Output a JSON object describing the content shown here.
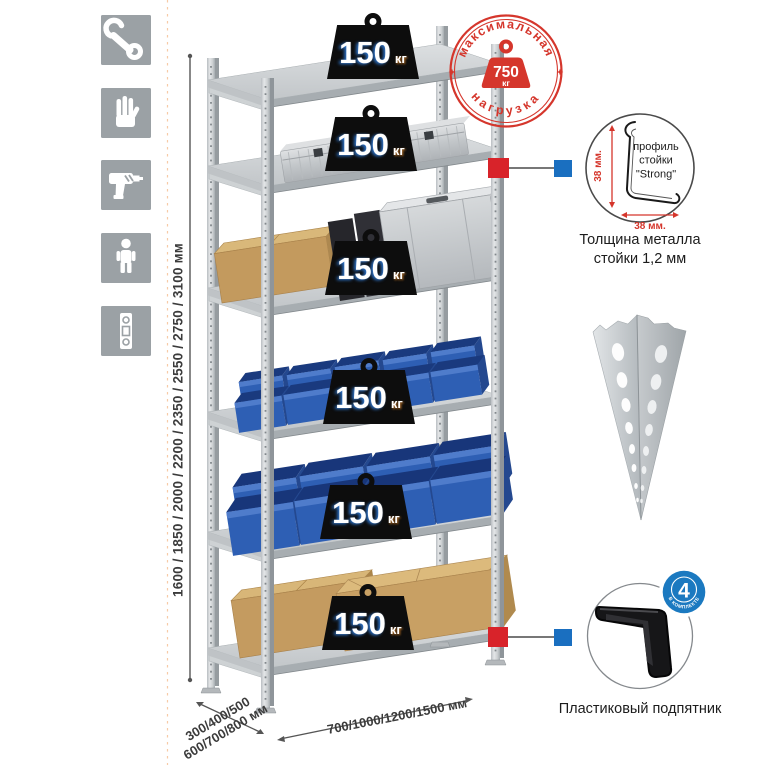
{
  "left_toolbar": {
    "icons": [
      "wrench-icon",
      "gloves-icon",
      "drill-icon",
      "person-icon",
      "level-icon"
    ]
  },
  "rack": {
    "shelf_loads": [
      {
        "value": "150",
        "unit": "кг"
      },
      {
        "value": "150",
        "unit": "кг"
      },
      {
        "value": "150",
        "unit": "кг"
      },
      {
        "value": "150",
        "unit": "кг"
      },
      {
        "value": "150",
        "unit": "кг"
      },
      {
        "value": "150",
        "unit": "кг"
      }
    ]
  },
  "stamp": {
    "arc_top": "максимальная",
    "arc_bottom": "нагрузка",
    "value": "750",
    "unit": "кг",
    "color": "#d5362c"
  },
  "dimensions": {
    "height_options": "1600 / 1850 / 2000 / 2200 / 2350 / 2550 / 2750 / 3100 мм",
    "depth_options_line1": "300/400/500",
    "depth_options_line2": "600/700/800 мм",
    "width_options": "700/1000/1200/1500 мм"
  },
  "profile_detail": {
    "line1": "профиль",
    "line2": "стойки",
    "line3": "\"Strong\"",
    "dim_vertical": "38 мм.",
    "dim_horizontal": "38 мм.",
    "caption": "Толщина металла стойки 1,2 мм"
  },
  "foot_detail": {
    "badge_value": "4",
    "badge_label": "в комплекте",
    "caption": "Пластиковый подпятник"
  },
  "colors": {
    "stamp_red": "#d5362c",
    "bin_blue": "#2e5fb4",
    "badge_blue": "#1b79c0",
    "marker_red": "#d8232a",
    "marker_blue": "#1a6fc0",
    "icon_gray": "#9ba1a5",
    "metal_gray": "#c9cdd0"
  }
}
